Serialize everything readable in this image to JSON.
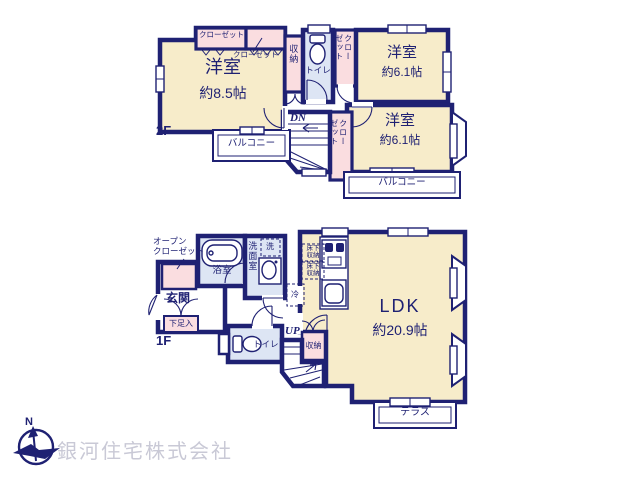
{
  "colors": {
    "wall_navy": "#1f2173",
    "room_cream": "#f7ecca",
    "closet_pink": "#fadde0",
    "wet_area_blue": "#dde5f4",
    "company_text_gray": "#c9c9d6"
  },
  "floor2": {
    "label": "2F",
    "bedroom_main": {
      "name": "洋室",
      "size": "約8.5帖"
    },
    "bedroom_top_right": {
      "name": "洋室",
      "size": "約6.1帖"
    },
    "bedroom_bottom_right": {
      "name": "洋室",
      "size": "約6.1帖"
    },
    "closet_a": "クローゼット",
    "closet_b": "クローゼット",
    "storage": "収納",
    "toilet": "トイレ",
    "closet_top_right": "クローゼット",
    "closet_bottom_right": "クローゼット",
    "balcony_left": "バルコニー",
    "balcony_right": "バルコニー",
    "stairs_down": "DN"
  },
  "floor1": {
    "label": "1F",
    "open_closet": "オープン\nクローゼット",
    "entrance": "玄関",
    "shoe_cabinet": "下足入",
    "bathroom": "浴室",
    "washroom": "洗面室",
    "laundry": "洗",
    "refrigerator": "冷",
    "underfloor_storage_1": "床下\n収納",
    "underfloor_storage_2": "床下\n収納",
    "toilet": "トイレ",
    "stairs_up": "UP",
    "storage": "収納",
    "ldk": {
      "name": "LDK",
      "size": "約20.9帖"
    },
    "terrace": "テラス"
  },
  "footer": {
    "company_name": "銀河住宅株式会社",
    "compass_north": "N"
  }
}
